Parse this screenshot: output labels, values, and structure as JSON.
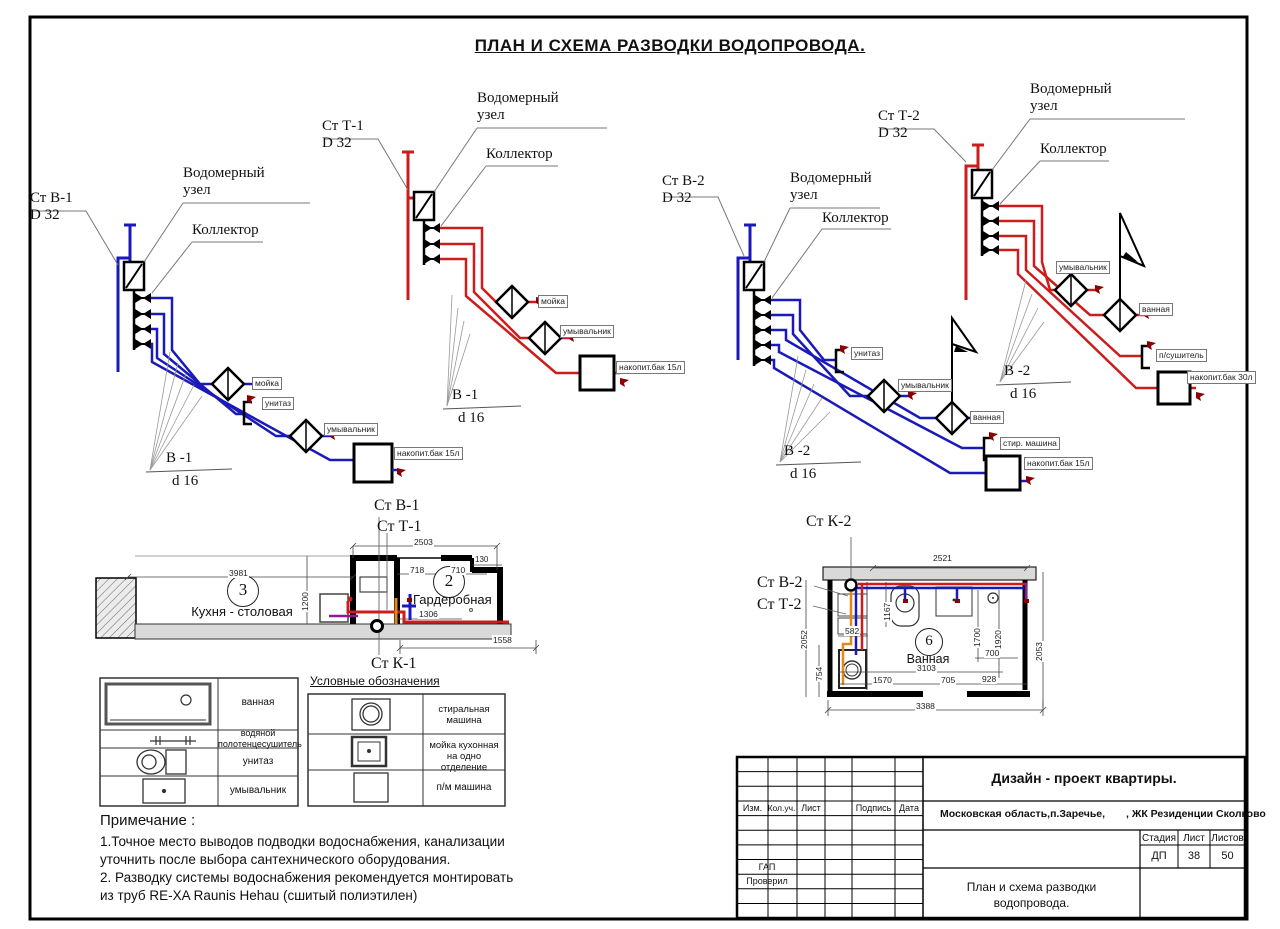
{
  "title": "ПЛАН  И СХЕМА РАЗВОДКИ ВОДОПРОВОДА.",
  "colors": {
    "cold": "#1a1ab8",
    "hot": "#cc1c1c",
    "outlet": "#8b0000",
    "orange": "#e08a1e",
    "purple": "#8a1a9a",
    "wall": "#d9d9d9"
  },
  "schematics": [
    {
      "stack": "Ст В-1",
      "diameter": "D 32",
      "meter1": "Водомерный",
      "meter2": "узел",
      "collector": "Коллектор",
      "branch": "В -1",
      "branch_d": "d 16",
      "fixtures": [
        "мойка",
        "унитаз",
        "умывальник",
        "накопит.бак 15л"
      ]
    },
    {
      "stack": "Ст Т-1",
      "diameter": "D 32",
      "meter1": "Водомерный",
      "meter2": "узел",
      "collector": "Коллектор",
      "branch": "В -1",
      "branch_d": "d 16",
      "fixtures": [
        "мойка",
        "умывальник",
        "накопит.бак 15л"
      ]
    },
    {
      "stack": "Ст В-2",
      "diameter": "D 32",
      "meter1": "Водомерный",
      "meter2": "узел",
      "collector": "Коллектор",
      "branch": "В -2",
      "branch_d": "d 16",
      "fixtures": [
        "унитаз",
        "умывальник",
        "ванная",
        "стир. машина",
        "накопит.бак 15л"
      ]
    },
    {
      "stack": "Ст Т-2",
      "diameter": "D 32",
      "meter1": "Водомерный",
      "meter2": "узел",
      "collector": "Коллектор",
      "branch": "В -2",
      "branch_d": "d 16",
      "fixtures": [
        "умывальник",
        "ванная",
        "п/сушитель",
        "накопит.бак 30л"
      ]
    }
  ],
  "kitchen_plan": {
    "stack_v": "Ст В-1",
    "stack_t": "Ст Т-1",
    "stack_k": "Ст К-1",
    "room_kitchen_num": "3",
    "room_kitchen": "Кухня - столовая",
    "room_ward_num": "2",
    "room_ward": "Гардеробная",
    "dims": {
      "d3981": "3981",
      "d2503": "2503",
      "d130": "130",
      "d718": "718",
      "d710": "710",
      "d1200": "1200",
      "d1306": "1306",
      "d1558": "1558"
    }
  },
  "bath_plan": {
    "stack_k": "Ст К-2",
    "stack_v": "Ст В-2",
    "stack_t": "Ст Т-2",
    "room_num": "6",
    "room": "Ванная",
    "dims": {
      "d2521": "2521",
      "d1167": "1167",
      "d2052": "2052",
      "d582": "582",
      "d754": "754",
      "d1570": "1570",
      "d3103": "3103",
      "d705": "705",
      "d928": "928",
      "d3388": "3388",
      "d1700": "1700",
      "d1920": "1920",
      "d700": "700",
      "d2053": "2053"
    }
  },
  "legend": {
    "header": "Условные обозначения",
    "left": [
      "ванная",
      "водяной полотенцесушитель",
      "унитаз",
      "умывальник"
    ],
    "right": [
      "стиральная машина",
      "мойка кухонная на одно отделение",
      "п/м машина"
    ]
  },
  "notes": {
    "heading": "Примечание :",
    "lines": [
      "1.Точное место выводов подводки водоснабжения, канализации",
      "уточнить после выбора сантехнического оборудования.",
      "2. Разводку системы водоснабжения рекомендуется монтировать",
      "из труб RE-XA Raunis Hehau (сшитый полиэтилен)"
    ]
  },
  "titleblock": {
    "project": "Дизайн - проект  квартиры.",
    "location": "Московская область,п.Заречье,",
    "complex": ", ЖК Резиденции Сколково",
    "doc_title1": "План  и схема разводки",
    "doc_title2": "водопровода.",
    "col_izm": "Изм.",
    "col_kol": "Кол.уч.",
    "col_list": "Лист",
    "col_podpis": "Подпись",
    "col_data": "Дата",
    "row_gap": "ГАП",
    "row_proveril": "Проверил",
    "stage_label": "Стадия",
    "sheet_label": "Лист",
    "sheets_label": "Листов",
    "stage": "ДП",
    "sheet": "38",
    "sheets": "50"
  }
}
